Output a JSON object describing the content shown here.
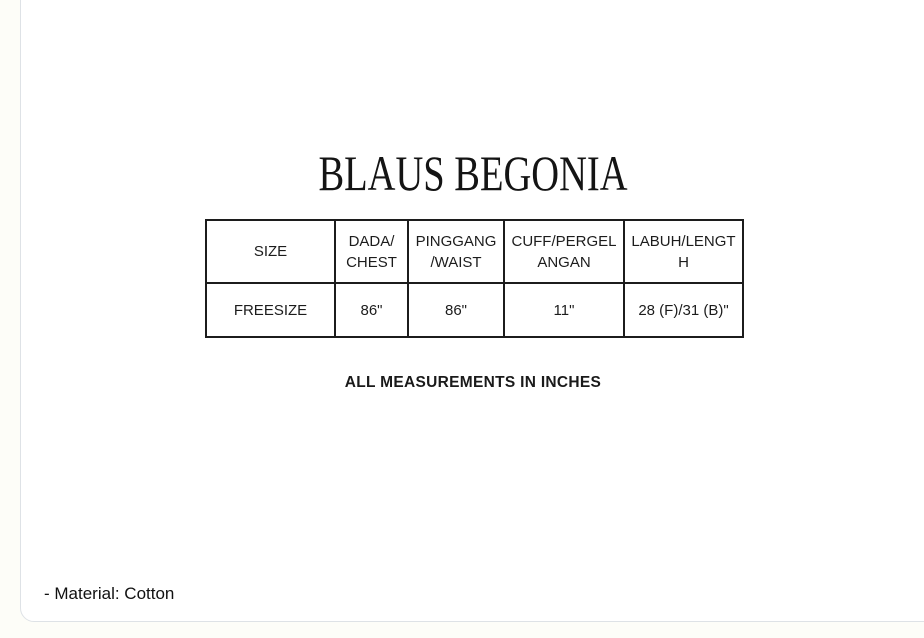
{
  "product": {
    "title": "BLAUS BEGONIA",
    "note": "ALL MEASUREMENTS IN INCHES",
    "material": "- Material: Cotton"
  },
  "size_table": {
    "headers": [
      "SIZE",
      "DADA/\nCHEST",
      "PINGGANG\n/WAIST",
      "CUFF/PERGEL\nANGAN",
      "LABUH/LENGT\nH"
    ],
    "rows": [
      [
        "FREESIZE",
        "86\"",
        "86\"",
        "11\"",
        "28 (F)/31 (B)\""
      ]
    ]
  },
  "colors": {
    "table_border": "#1c1c1c",
    "table_text": "#1c1c1c",
    "card_border": "#dee2e6",
    "background_below_card": "#fdfdf8"
  }
}
